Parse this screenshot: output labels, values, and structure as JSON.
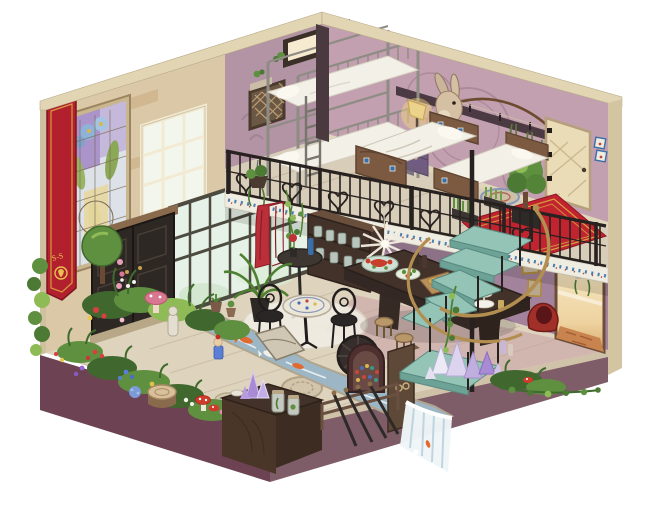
{
  "artwork": {
    "banner_text": "S-S",
    "description": "Isometric cutaway illustration of a two-story fantasy inn room",
    "inventory": [
      "bunk bed with white bedding",
      "double bed with tiled headboard",
      "second bed",
      "rabbit trophy head",
      "hunting bow",
      "dried herb bunches",
      "wall alcove window",
      "lattice vent",
      "table lamp on purple nightstand",
      "wrought-iron loft railing",
      "blue tile fascia band",
      "red carpet landing with gold border",
      "round rug",
      "grass planters",
      "topiary tree in planter",
      "cream loft door",
      "tile accent",
      "spiral staircase with brass handrail",
      "crystal cluster",
      "stair ivy",
      "stained glass window",
      "red guild banner",
      "dark entrance double door",
      "conservatory glass wall",
      "white window grid",
      "red curtain",
      "hanging sprigs",
      "bookshelf with jars",
      "white feather chandelier",
      "bistro table with rose and blue bottle",
      "mosaic cafe table",
      "two black cafe chairs",
      "white area rug",
      "potted palm",
      "banquet table with lobster platter, salad, bread and desserts",
      "wooden stools",
      "indoor garden with flowers and mushrooms",
      "ball topiary",
      "tree stump",
      "pink mushroom",
      "garden statue",
      "garden figurine",
      "koi stream",
      "stone bridge",
      "waterfall over ledge",
      "water wheel",
      "work desk with amethyst and jars",
      "arch display rack",
      "small cabinet with ring pulls",
      "pole rack",
      "blue runner rug",
      "open doorway with warm light",
      "hanging plant",
      "picture frames",
      "red basket chair",
      "vines on plinth"
    ]
  },
  "colors": {
    "background": "#ffffff",
    "plinthLeft": "#6d4252",
    "plinthRight": "#7e5c68",
    "edgeCream": "#e2d5b4",
    "outerEdge": "#d3c4a2",
    "wallStone": "#dbc8a7",
    "wallMauveLeft": "#b294a4",
    "wallMauveRight": "#c2a0af",
    "wallLowerRight": "#a2839b",
    "floorCream": "#ded3bd",
    "floorPink": "#c8a4a6",
    "glassMint": "#e6f2e7",
    "bannerRed": "#b3202d",
    "gold": "#d9a842",
    "carpetRed": "#c1242f",
    "stepTeal": "#93c4b6",
    "brass": "#b28e50",
    "iron": "#27211f",
    "bedding": "#f3f0e7",
    "woodDark": "#42322a",
    "woodMid": "#7c5a41",
    "loftWood": "#d8cdb8",
    "foliage": "#5f9040",
    "foliageDark": "#40682e",
    "foliageLight": "#8fbb56",
    "water": "#9cb6c5",
    "foam": "#f0f6f8",
    "koiOrange": "#e06a31",
    "curtainRed": "#b9303a",
    "crystalPurple": "#a98bd5",
    "lampGlow": "#f6d87a"
  }
}
